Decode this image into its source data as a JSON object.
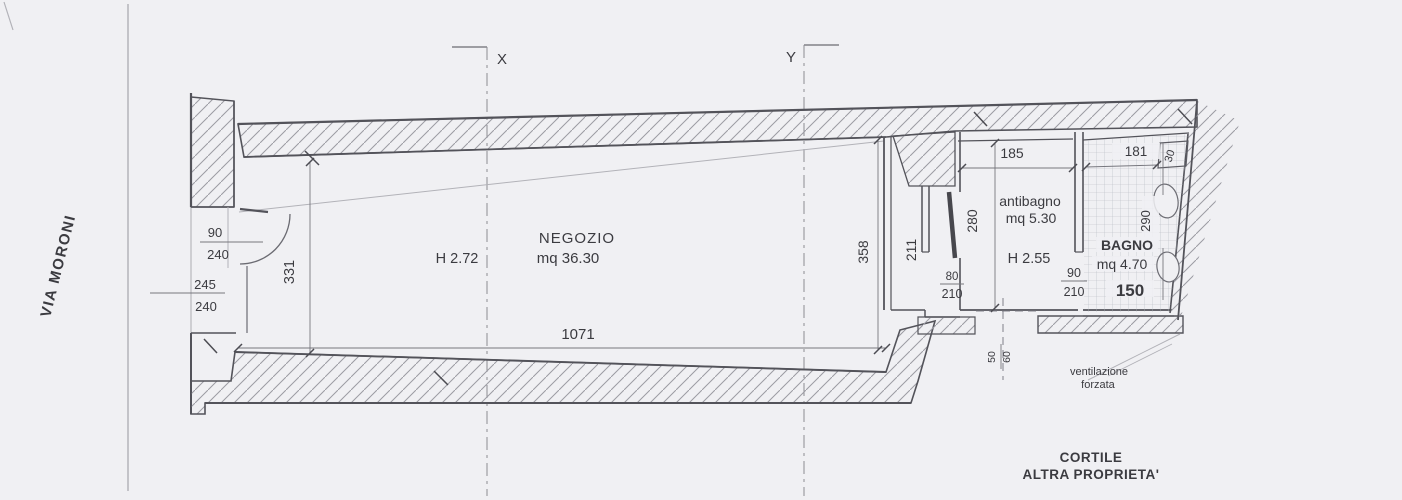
{
  "plan": {
    "street": "VIA MORONI",
    "section_x": "X",
    "section_y": "Y",
    "negozio": {
      "name": "NEGOZIO",
      "area": "mq 36.30",
      "height": "H 2.72",
      "dim_width": "1071",
      "dim_left": "331",
      "dim_right": "358",
      "door": {
        "w": "90",
        "h": "240"
      },
      "opening": {
        "w": "245",
        "h": "240"
      }
    },
    "corridor": {
      "dim": "211"
    },
    "antibagno": {
      "name": "antibagno",
      "area": "mq 5.30",
      "height": "H 2.55",
      "dim_width": "185",
      "dim_depth": "280",
      "door": {
        "w": "80",
        "h": "210"
      }
    },
    "bagno": {
      "name": "BAGNO",
      "area": "mq 4.70",
      "dim_top": "181",
      "dim_depth": "290",
      "dim_bottom": "150",
      "shaft": "30",
      "door": {
        "w": "90",
        "h": "210"
      }
    },
    "vent": {
      "w": "50",
      "h": "60",
      "label1": "ventilazione",
      "label2": "forzata"
    },
    "courtyard": {
      "line1": "CORTILE",
      "line2": "ALTRA PROPRIETA'"
    },
    "colors": {
      "paper": "#f0f0f3",
      "ink": "#3b3b40",
      "wall": "#53535a",
      "hatch": "#9b9ba3"
    }
  }
}
